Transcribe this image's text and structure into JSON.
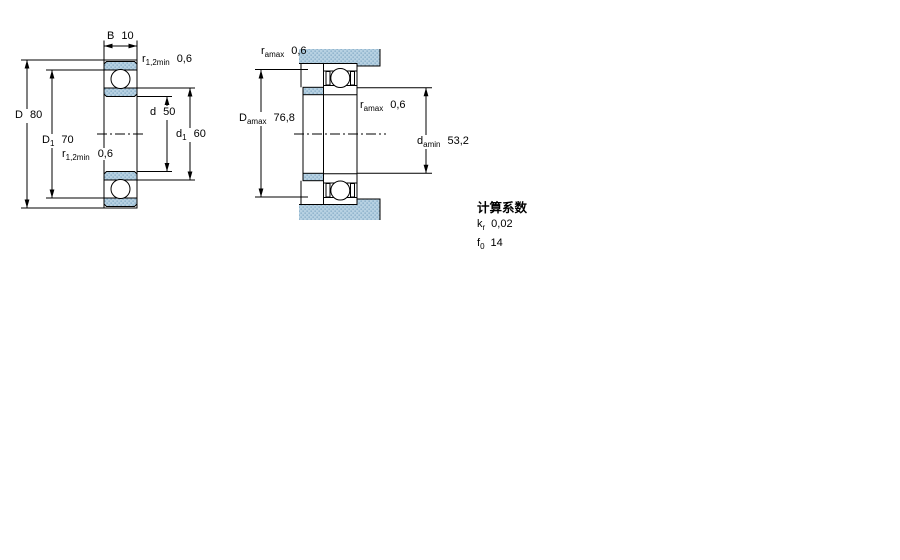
{
  "colors": {
    "line": "#000000",
    "section_fill_base": "#b7d1e2",
    "section_fill_dot": "#7fa8c3",
    "background": "#ffffff"
  },
  "left_diagram": {
    "description": "bearing cross-section with boundary dimensions",
    "labels": {
      "width": {
        "pre": "B",
        "sub": "",
        "value": "10"
      },
      "chamfer_top": {
        "pre": "r",
        "sub": "1,2min",
        "value": "0,6"
      },
      "outer_diameter": {
        "pre": "D",
        "sub": "",
        "value": "80"
      },
      "recess_diameter": {
        "pre": "D",
        "sub": "1",
        "value": "70"
      },
      "chamfer_bottom": {
        "pre": "r",
        "sub": "1,2min",
        "value": "0,6"
      },
      "bore_diameter": {
        "pre": "d",
        "sub": "",
        "value": "50"
      },
      "shoulder_diameter": {
        "pre": "d",
        "sub": "1",
        "value": "60"
      }
    }
  },
  "right_diagram": {
    "description": "mounted bearing with abutment and fillet dimensions",
    "labels": {
      "fillet_top": {
        "pre": "r",
        "sub": "amax",
        "value": "0,6"
      },
      "housing_abutment": {
        "pre": "D",
        "sub": "amax",
        "value": "76,8"
      },
      "fillet_mid": {
        "pre": "r",
        "sub": "amax",
        "value": "0,6"
      },
      "shaft_abutment": {
        "pre": "d",
        "sub": "amin",
        "value": "53,2"
      }
    }
  },
  "calculation_factors": {
    "heading": "计算系数",
    "rows": [
      {
        "pre": "k",
        "sub": "r",
        "value": "0,02"
      },
      {
        "pre": "f",
        "sub": "0",
        "value": "14"
      }
    ]
  }
}
